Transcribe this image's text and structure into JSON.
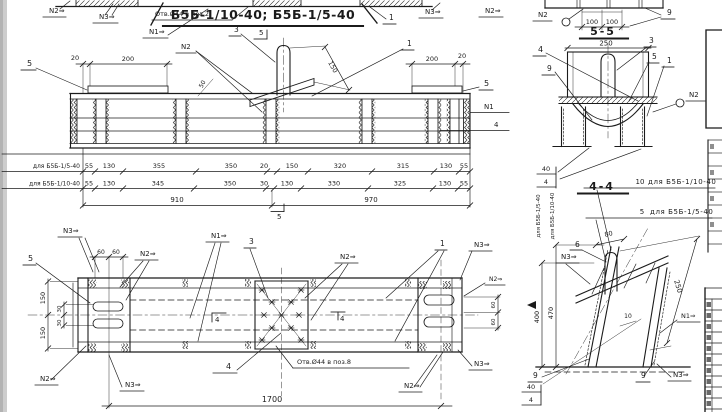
{
  "title": "Б5Б-1/10-40; Б5Б-1/5-40",
  "marks": {
    "n1": "N1⇒",
    "n2": "N2⇒",
    "n3": "N3⇒",
    "n1_plain": "N1",
    "n2_plain": "N2"
  },
  "parts": {
    "p1": "1",
    "p3": "3",
    "p4": "4",
    "p5": "5",
    "p6": "6",
    "p9": "9"
  },
  "sections": {
    "s55": "5-5",
    "s44": "4-4",
    "cut5": "5",
    "cut4": "4",
    "cut40": "40"
  },
  "notes": {
    "holes_pos2": "Отв.Ø44 в поз.2",
    "holes_pos8": "Отв.Ø44 в поз.8",
    "qty10": "10",
    "qty5": "5",
    "for_1_10": "для Б5Б-1/10-40",
    "for_1_5": "для Б5Б-1/5-40"
  },
  "dims": {
    "d20": "20",
    "d200": "200",
    "d150": "150",
    "d50": "50",
    "d100": "100",
    "d250": "250",
    "d60": "60",
    "d30": "30",
    "d80": "80",
    "d400": "400",
    "d470": "470",
    "d10": "10",
    "d1700": "1700"
  },
  "dim_rows": {
    "row1": {
      "label": "для Б5Б-1/5-40",
      "values": [
        "55",
        "130",
        "355",
        "350",
        "20",
        "150",
        "320",
        "315",
        "130",
        "55"
      ]
    },
    "row2": {
      "label": "для Б5Б-1/10-40",
      "values": [
        "55",
        "130",
        "345",
        "350",
        "30",
        "130",
        "330",
        "325",
        "130",
        "55"
      ]
    },
    "total_left": "910",
    "total_right": "970"
  }
}
